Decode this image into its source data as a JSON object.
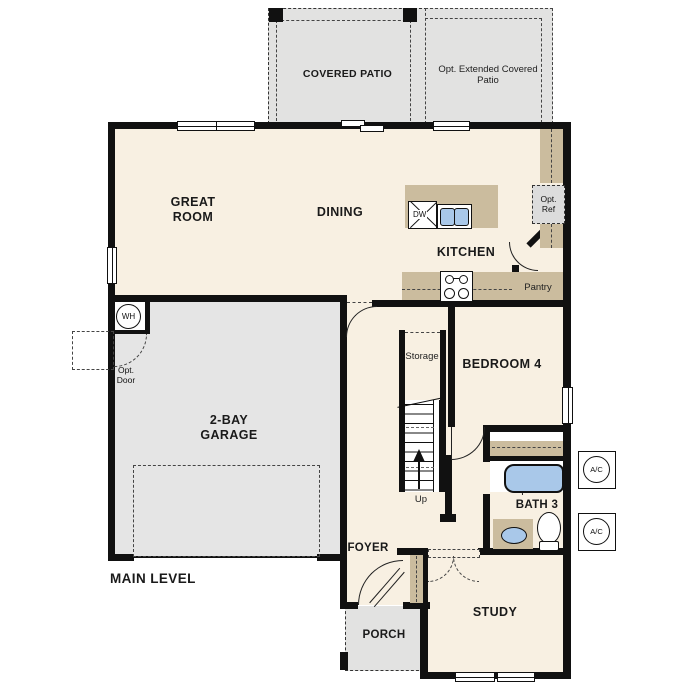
{
  "plan": {
    "title": "MAIN LEVEL",
    "patio": {
      "covered": "COVERED PATIO",
      "extended": "Opt. Extended Covered Patio"
    },
    "rooms": {
      "great_room": "GREAT ROOM",
      "dining": "DINING",
      "kitchen": "KITCHEN",
      "garage": "2-BAY GARAGE",
      "bedroom4": "BEDROOM 4",
      "bath3": "BATH 3",
      "foyer": "FOYER",
      "porch": "PORCH",
      "study": "STUDY",
      "pantry": "Pantry",
      "storage": "Storage"
    },
    "fixtures": {
      "dw": "DW",
      "wh": "WH",
      "ac1": "A/C",
      "ac2": "A/C",
      "opt_ref": "Opt. Ref",
      "opt_door": "Opt. Door",
      "up": "Up"
    },
    "colors": {
      "interior": "#f8f0e2",
      "garage": "#e5e5e5",
      "patio": "#e2e2e1",
      "counter": "#cbbc9e",
      "fixture_blue": "#a9c8e9",
      "wall": "#111111"
    }
  }
}
